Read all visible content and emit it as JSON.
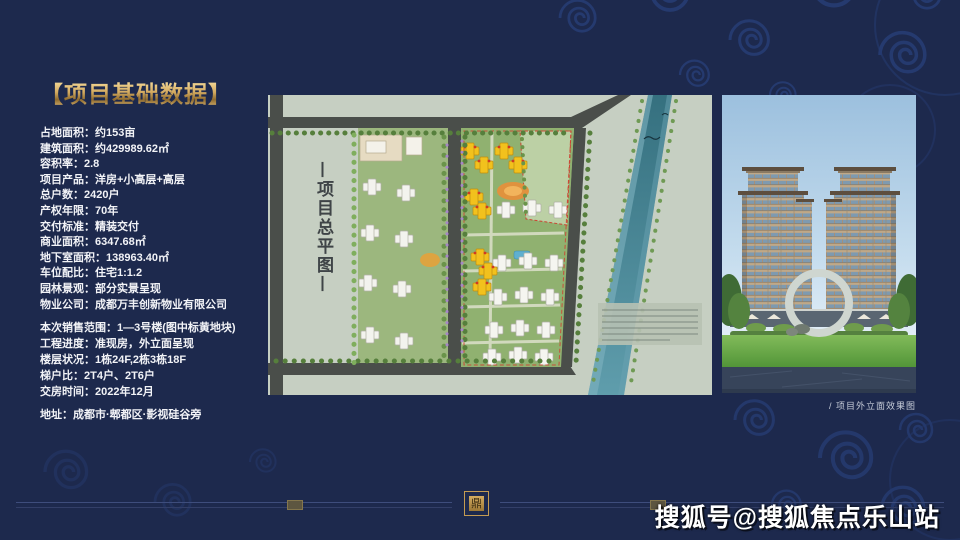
{
  "page": {
    "watermark": "搜狐号@搜狐焦点乐山站"
  },
  "left_panel": {
    "title": "【项目基础数据】",
    "basic_data": [
      "占地面积：约153亩",
      "建筑面积：约429989.62㎡",
      "容积率：2.8",
      "项目产品：洋房+小高层+高层",
      "总户数：2420户",
      "产权年限：70年",
      "交付标准：精装交付",
      "商业面积：6347.68㎡",
      "地下室面积：138963.40㎡",
      "车位配比：住宅1:1.2",
      "园林景观：部分实景呈现",
      "物业公司：成都万丰创新物业有限公司"
    ],
    "sales_data": [
      "本次销售范围：1—3号楼(图中标黄地块)",
      "工程进度：准现房，外立面呈现",
      "楼层状况：1栋24F,2栋3栋18F",
      "梯户比：2T4户、2T6户",
      "交房时间：2022年12月"
    ],
    "address": "地址：成都市·郫都区·影视硅谷旁"
  },
  "map": {
    "vertical_title": "项目总平图",
    "vertical_title_display": "—项目总平图—",
    "highlight_note": "1—3号楼标黄地块"
  },
  "rendering": {
    "caption": "/ 项目外立面效果图"
  },
  "footer": {
    "seal_character": "鼎"
  },
  "colors": {
    "background_navy": "#1d294d",
    "cloud_pattern_blue": "#2f4f99",
    "accent_gold": "#cfa45c",
    "map_background": "#c6cfc2",
    "road_gray": "#4a4e4a",
    "river_teal": "#35707f",
    "highlight_yellow": "#f2c11d",
    "site_green": "#90b170",
    "text_white": "#f2f3f7"
  }
}
